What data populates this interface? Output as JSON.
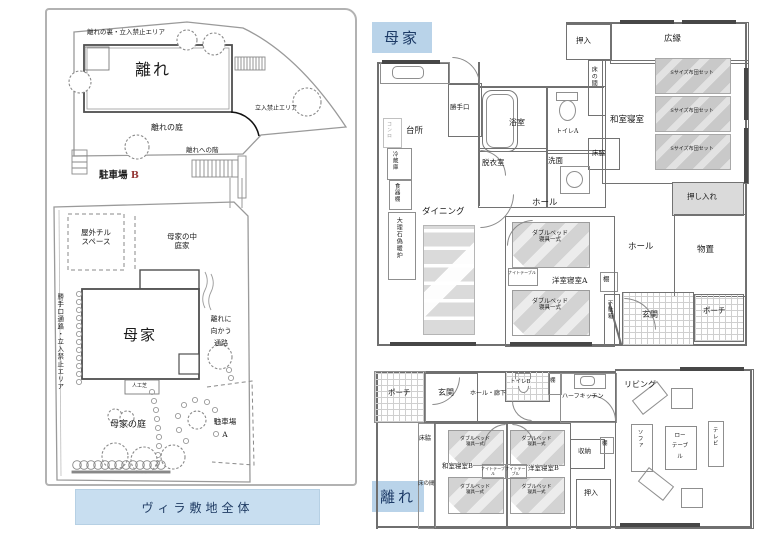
{
  "colors": {
    "label_box_bg": "#b9d3e9",
    "label_box_text": "#1c3a66",
    "caption_bg": "#c8def0",
    "plan_line": "#6f6f6f",
    "parking_b_letter": "#943634"
  },
  "site": {
    "caption": "ヴィラ敷地全体",
    "area_labels": {
      "hanare_back": "離れの裏・立入禁止エリア",
      "hanare_building": "離れ",
      "no_entry": "立入禁止エリア",
      "hanare_garden": "離れの庭",
      "hanare_stairs": "離れへの階",
      "parking_b": "駐車場",
      "parking_b_letter": "B",
      "chill_line1": "屋外チル",
      "chill_line2": "スペース",
      "courtyard_line1": "母家の中",
      "courtyard_line2": "庭家",
      "side_path_vertical": "勝手口通路・立入禁止エリア",
      "omoya_building": "母家",
      "to_hanare_line1": "離れに",
      "to_hanare_line2": "向かう",
      "to_hanare_line3": "通路",
      "artificial_turf": "人工芝",
      "omoya_garden": "母家の庭",
      "parking_a": "駐車場",
      "parking_a_letter": "A"
    }
  },
  "omoya": {
    "title": "母家",
    "rooms": {
      "kitchen": "台所",
      "back_door": "勝手口",
      "bath": "浴室",
      "toilet_a": "トイレA",
      "dressing": "脱衣室",
      "washstand": "洗面",
      "oshiire_top": "押入",
      "hiroen": "広縁",
      "tokonoma": "床の間",
      "washitsu": "和室寝室",
      "tokowaki": "床脇",
      "oshiire": "押し入れ",
      "dining": "ダイニング",
      "hall_upper": "ホール",
      "hall_lower": "ホール",
      "storage": "物置",
      "entrance": "玄関",
      "porch": "ポーチ",
      "shelf": "棚",
      "geta_box": "下駄箱",
      "yoshitsu_a": "洋室寝室A"
    },
    "furniture": {
      "stove": "コンロ",
      "fridge": "冷蔵庫",
      "cupboard": "食器棚",
      "fireplace": "大理石偽暖炉",
      "futon_set": "Sサイズ布団セット",
      "bed_line1": "ダブルベッド",
      "bed_line2": "寝具一式",
      "night_table": "ナイトテーブル"
    }
  },
  "hanare": {
    "title": "離れ",
    "rooms": {
      "porch": "ポーチ",
      "entrance": "玄関",
      "hall": "ホール・廊下",
      "toilet_b": "トイレB",
      "shelf": "棚",
      "half_kitchen": "ハーフキッチン",
      "tokowaki": "床脇",
      "tokonoma": "床の間",
      "washitsu_b": "和室寝室B",
      "yoshitsu_b": "洋室寝室B",
      "storage": "収納",
      "oshiire": "押入",
      "living": "リビング"
    },
    "furniture": {
      "bed_line1": "ダブルベッド",
      "bed_line2": "寝具一式",
      "night_table": "ナイトテーブル",
      "sofa": "ソファ",
      "low_table_l1": "ロー",
      "low_table_l2": "テーブ",
      "low_table_l3": "ル",
      "tv": "テレビ"
    }
  }
}
